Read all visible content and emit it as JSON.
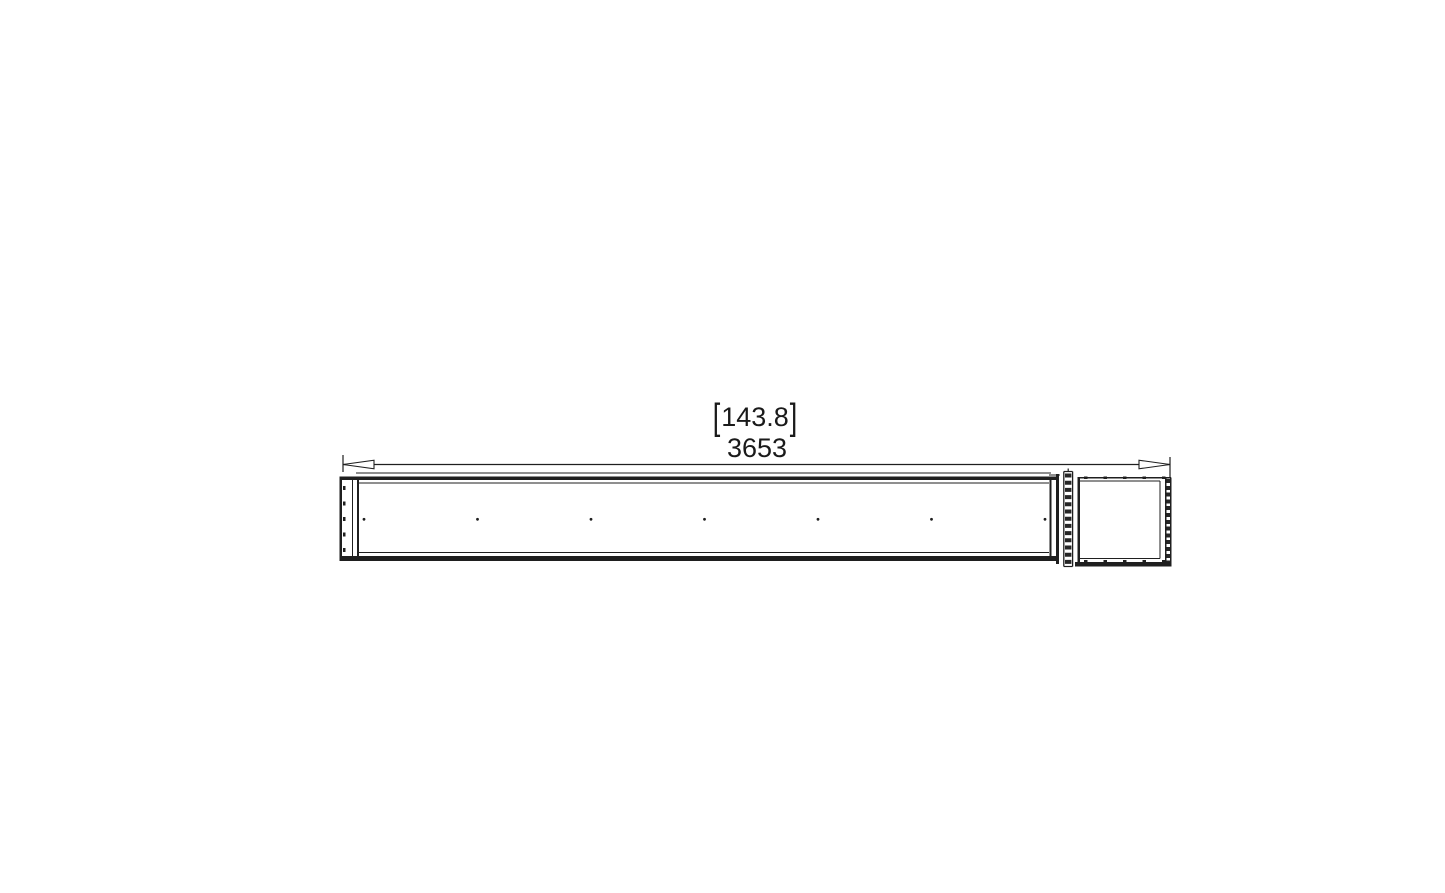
{
  "drawing": {
    "type": "technical-dimension-drawing",
    "background": "#ffffff",
    "line_color": "#1f1f1f",
    "text_color": "#1a1a1a",
    "dimension": {
      "bracket_open": "[",
      "imperial_value": "143.8",
      "bracket_close": "]",
      "metric_value": "3653"
    },
    "burner_ports": {
      "count": 7
    }
  }
}
